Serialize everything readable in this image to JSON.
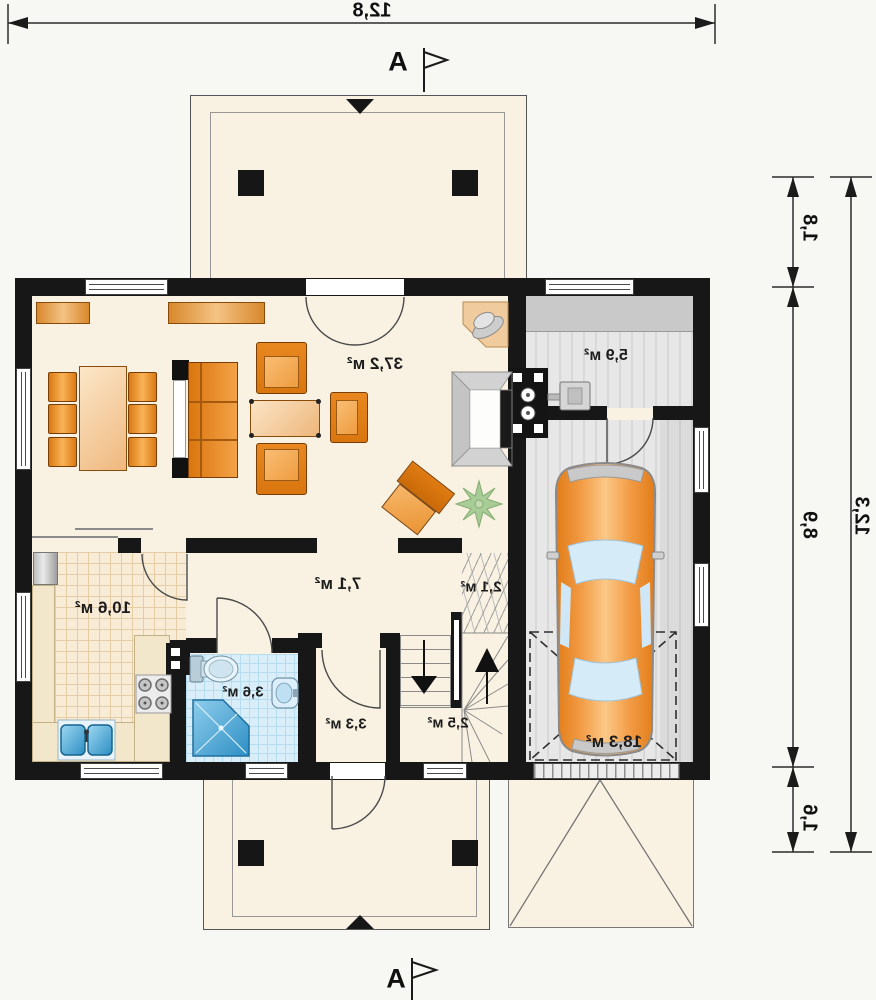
{
  "plan": {
    "section_label": "A",
    "dims": {
      "top_width": "12,8",
      "right_total": "12,3",
      "right_upper": "1,8",
      "right_middle": "8,9",
      "right_lower": "1,6"
    },
    "rooms": {
      "living": "37,2 м²",
      "utility": "5,9 м²",
      "garage": "18,3 м²",
      "kitchen": "10,6 м²",
      "hall": "7,1 м²",
      "pantry": "2,1 м²",
      "bathroom": "3,6 м²",
      "vestibule": "3,3 м²",
      "stair": "2,5 м²"
    },
    "colors": {
      "wall": "#171717",
      "floor": "#f9f2e2",
      "furniture_orange": "#e8871f",
      "bath_tile": "#d9eef9",
      "garage_floor": "#e7e7e7",
      "car_orange": "#f0953a"
    }
  }
}
